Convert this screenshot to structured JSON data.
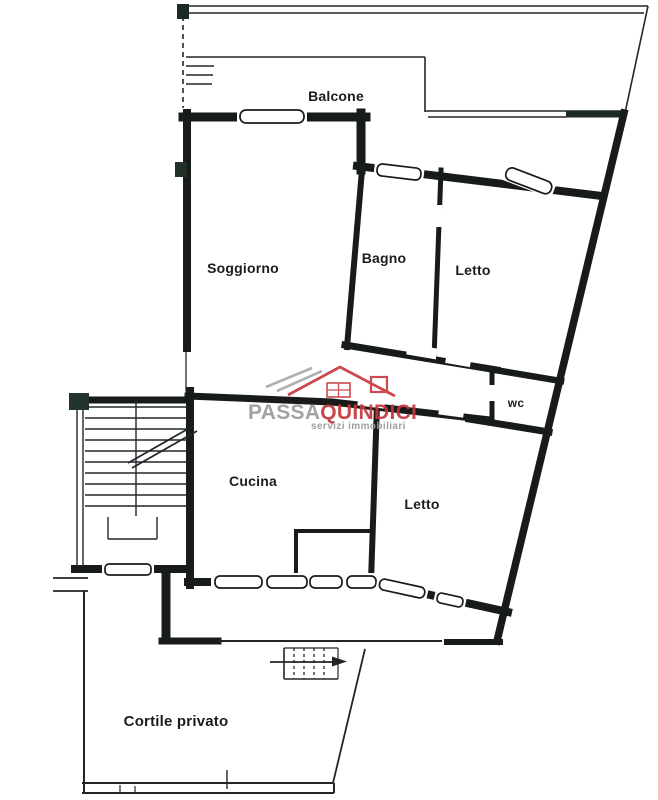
{
  "rooms": {
    "balcone": "Balcone",
    "soggiorno": "Soggiorno",
    "bagno": "Bagno",
    "letto_top": "Letto",
    "wc": "wc",
    "cucina": "Cucina",
    "letto_bottom": "Letto",
    "cortile": "Cortile privato"
  },
  "watermark": {
    "brand_primary": "PASSA",
    "brand_secondary": "QUINDICI",
    "tagline": "servizi immobiliari",
    "icon": "roof-house-icon",
    "color_gray": "#9b9b9e",
    "color_red": "#c5373d"
  },
  "colors": {
    "wall": "#171b19",
    "paper": "#ffffff"
  }
}
